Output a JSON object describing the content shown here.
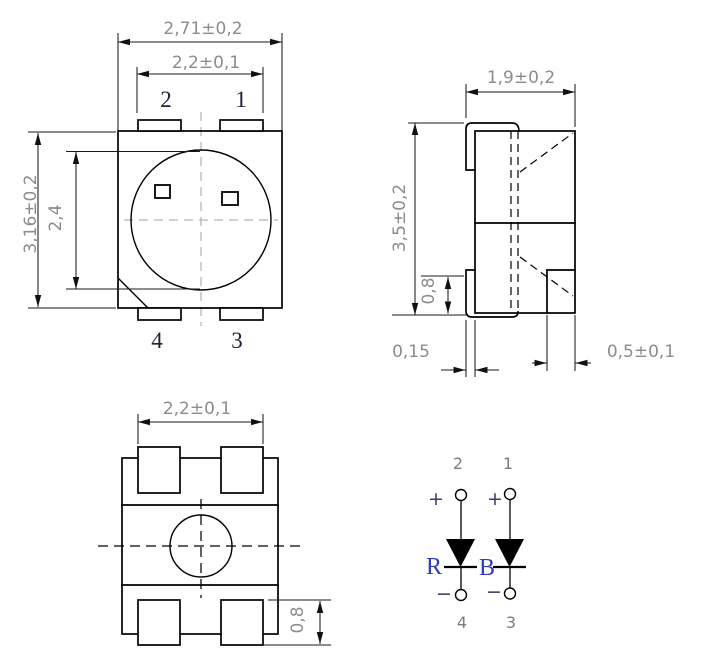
{
  "front_view": {
    "dim_outer_width": "2,71±0,2",
    "dim_pad_span": "2,2±0,1",
    "dim_outer_height": "3,16±0,2",
    "dim_lens_height": "2,4",
    "pin_top_left": "2",
    "pin_top_right": "1",
    "pin_bottom_left": "4",
    "pin_bottom_right": "3"
  },
  "side_view": {
    "dim_depth": "1,9±0,2",
    "dim_height": "3,5±0,2",
    "dim_lead_height": "0,8",
    "dim_lead_thickness": "0,15",
    "dim_lead_width": "0,5±0,1"
  },
  "bottom_view": {
    "dim_pad_span": "2,2±0,1",
    "dim_pad_height": "0,8"
  },
  "schematic": {
    "red_diode": {
      "label": "R",
      "anode_pin": "2",
      "cathode_pin": "4",
      "anode_sign": "+",
      "cathode_sign": "−"
    },
    "blue_diode": {
      "label": "B",
      "anode_pin": "1",
      "cathode_pin": "3",
      "anode_sign": "+",
      "cathode_sign": "−"
    }
  },
  "colors": {
    "outline": "#000000",
    "dimension_text": "#8c8c8c",
    "front_pin_text": "#20203a",
    "schematic_pin_text": "#7d7d7d",
    "polarity_sign": "#3b3f63",
    "diode_label_blue": "#2d3dbb",
    "centerline_gray": "#b5b5b5",
    "background": "#ffffff"
  }
}
